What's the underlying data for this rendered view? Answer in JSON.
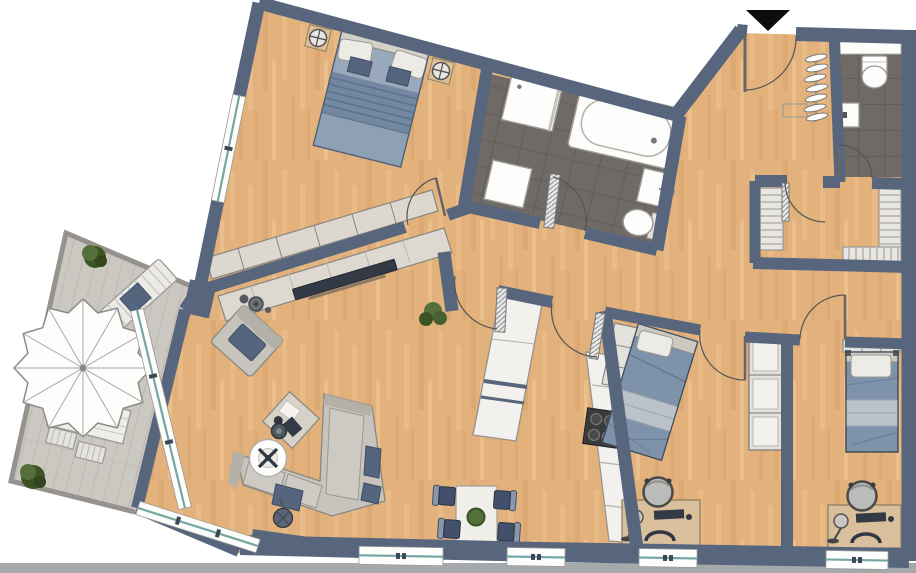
{
  "palette": {
    "background": "#ffffff",
    "ground_strip": "#a6a9ac",
    "wall": "#57667c",
    "floor": "#e2b17c",
    "floor_light": "#f0c996",
    "floor_dark": "#d09a62",
    "tile": "#6f6a66",
    "tile_line": "#5e5955",
    "deck": "#cbc8c2",
    "deck_line": "#b3b0aa",
    "glass": "#74a7a4",
    "white": "#fdfdfc",
    "outline_gray": "#9a9896",
    "furn_light": "#c7c4bd",
    "furn_mid": "#b3b0a8",
    "furn_outline": "#8a8781",
    "cushion": "#55657e",
    "bed_blue": "#7e93a9",
    "bed_blue_deep": "#5a7390",
    "bed_stripe": "#bcc2c9",
    "pillow": "#edebe6",
    "tan": "#d9bf9c",
    "wardrobe_beige": "#dcd8d0",
    "unit_white": "#f2f1ee",
    "navy": "#42506b",
    "navy_light": "#8b97a8",
    "plant": "#55703a",
    "plant_dark": "#3c5423",
    "stove": "#3a3a3a",
    "dark_item": "#333a45",
    "marker": "#0d0d0d"
  },
  "floor_plan": {
    "entrance_marker": "black-triangle-down",
    "rooms": [
      {
        "name": "bedroom",
        "furniture": [
          "double-bed",
          "nightstand-lamp-left",
          "nightstand-lamp-right",
          "built-in-wardrobe"
        ]
      },
      {
        "name": "bathroom",
        "furniture": [
          "shower",
          "bathtub",
          "washing-machine",
          "washbasin",
          "toilet"
        ]
      },
      {
        "name": "entry-hall",
        "furniture": [
          "coat-rack",
          "wall-shelf"
        ]
      },
      {
        "name": "guest-wc",
        "furniture": [
          "toilet",
          "washbasin",
          "window-shelf"
        ]
      },
      {
        "name": "storage-room",
        "furniture": [
          "shelf-left",
          "shelf-right",
          "shelf-bottom"
        ]
      },
      {
        "name": "living-room",
        "furniture": [
          "tv-sideboard",
          "tv",
          "speaker-bowls",
          "armchair",
          "corner-sofa",
          "coffee-table",
          "side-table",
          "stool",
          "floor-lamp",
          "plant"
        ]
      },
      {
        "name": "kitchen",
        "furniture": [
          "tall-cabinet",
          "counter",
          "cooktop"
        ]
      },
      {
        "name": "dining-area",
        "furniture": [
          "dining-table",
          "four-chairs",
          "table-plant"
        ]
      },
      {
        "name": "kids-room-1",
        "furniture": [
          "single-bed",
          "wardrobe-corner",
          "wardrobe-side",
          "desk",
          "desk-chair",
          "desk-lamp",
          "radiator"
        ]
      },
      {
        "name": "kids-room-2",
        "furniture": [
          "single-bed",
          "wardrobe-top",
          "desk",
          "desk-chair",
          "desk-lamp"
        ]
      },
      {
        "name": "terrace",
        "furniture": [
          "parasol",
          "sun-lounger",
          "garden-table",
          "two-benches",
          "plant-top",
          "plant-bottom"
        ]
      }
    ],
    "window_count": 8,
    "door_count": 10
  }
}
